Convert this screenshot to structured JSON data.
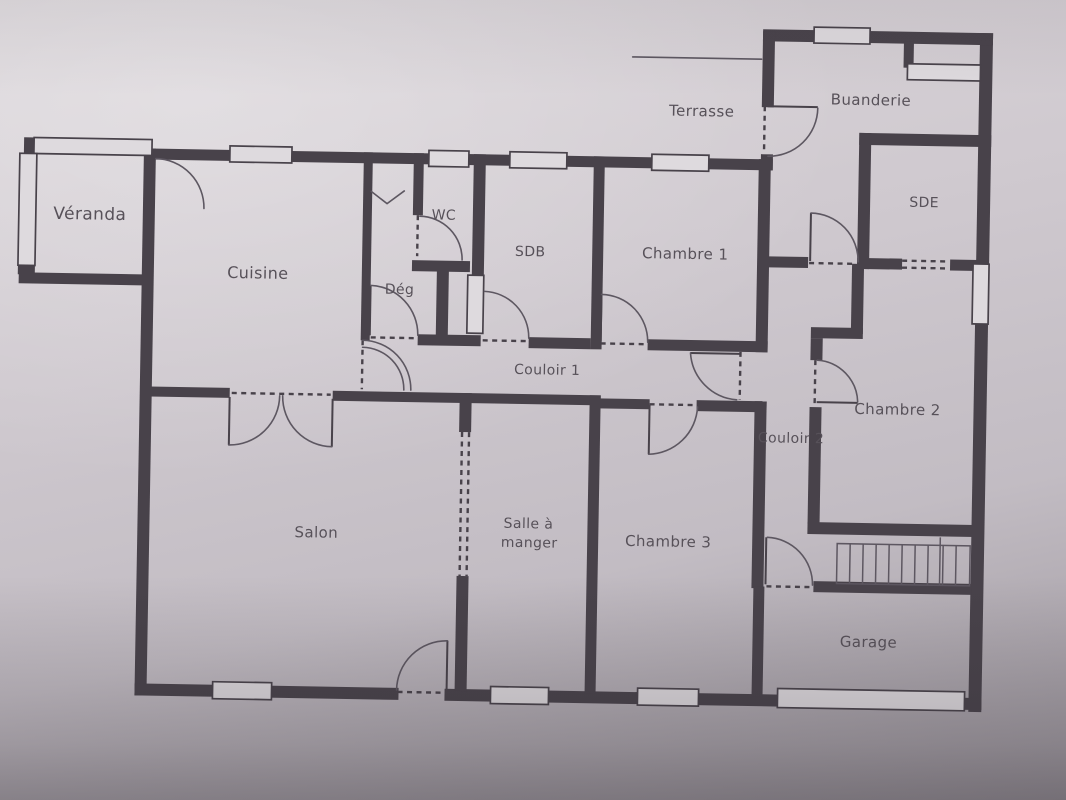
{
  "rooms": {
    "veranda": "Véranda",
    "cuisine": "Cuisine",
    "wc": "WC",
    "deg": "Dég",
    "sdb": "SDB",
    "chambre1": "Chambre 1",
    "terrasse": "Terrasse",
    "buanderie": "Buanderie",
    "sde": "SDE",
    "couloir1": "Couloir 1",
    "couloir2": "Couloir 2",
    "chambre2": "Chambre 2",
    "salon": "Salon",
    "salle_a_manger": {
      "line1": "Salle à",
      "line2": "manger"
    },
    "chambre3": "Chambre 3",
    "garage": "Garage"
  },
  "colors": {
    "paper": "#cfc9cf",
    "paper_bright": "#dcd7db",
    "paper_shadow": "#9a949b",
    "ink": "#48424a",
    "line": "#5d5761",
    "text": "#575159",
    "window_fill": "#dedade"
  }
}
